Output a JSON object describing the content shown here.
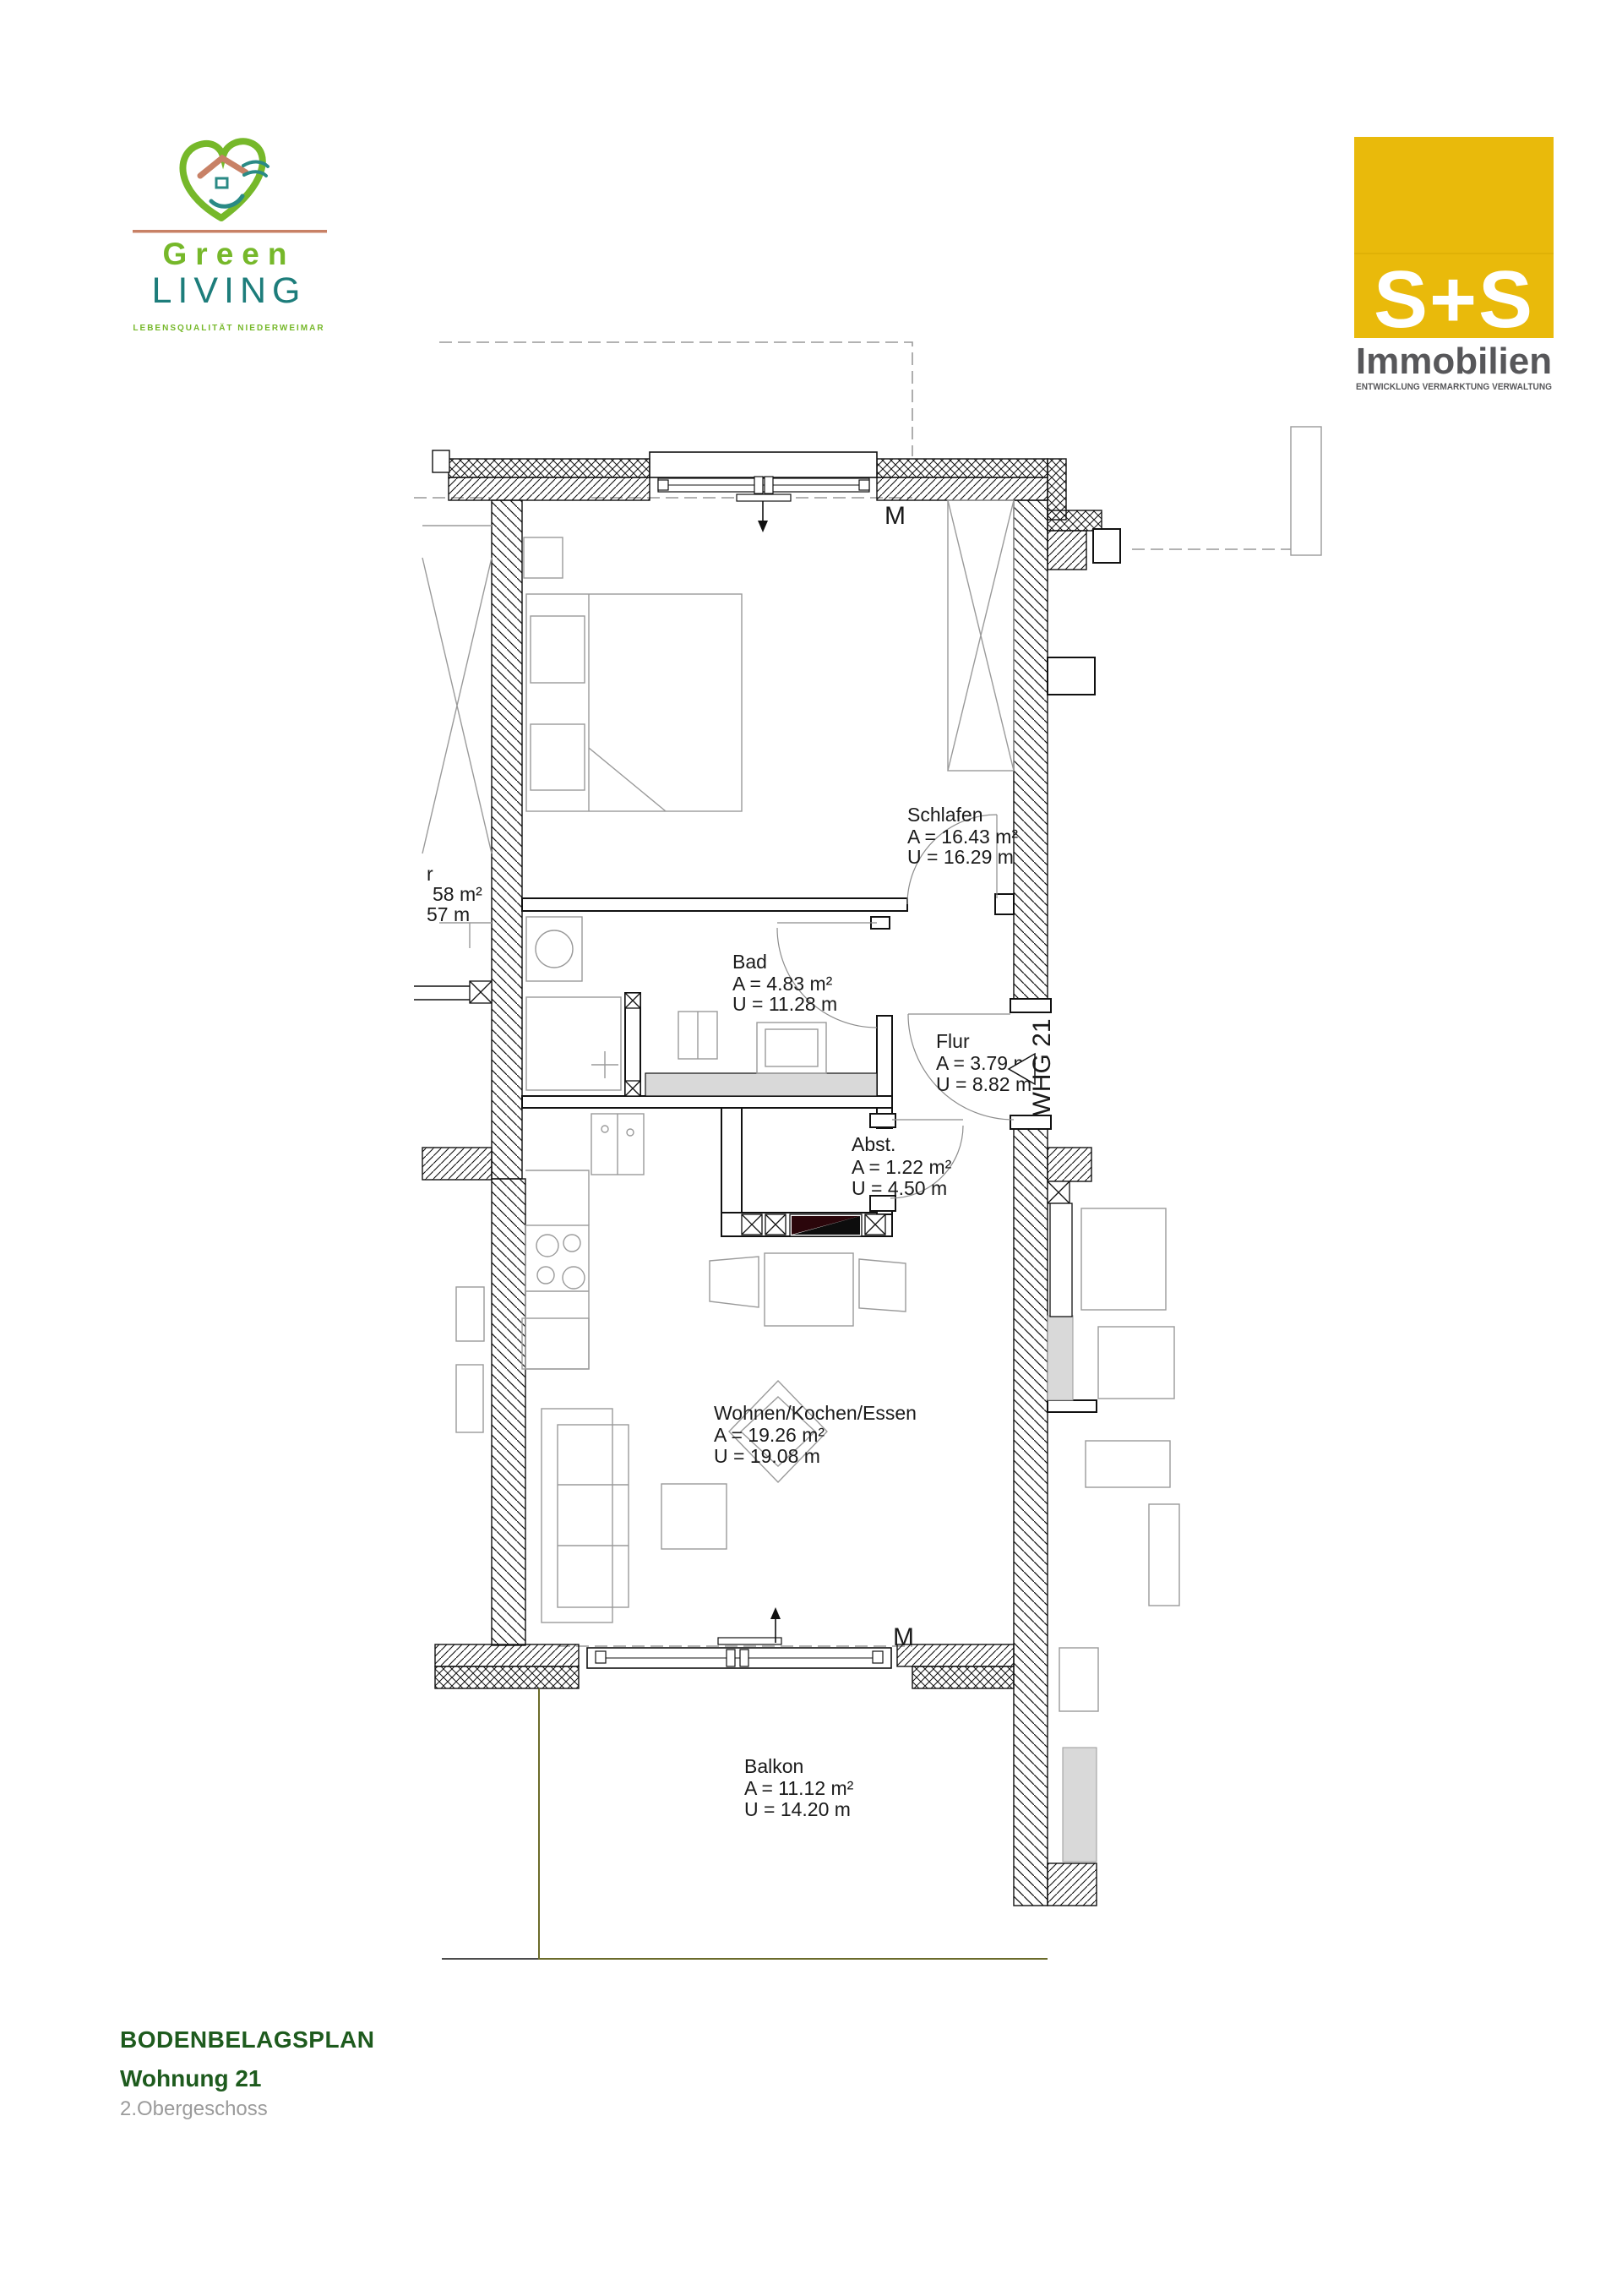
{
  "branding": {
    "green_living": {
      "name_line1": "Green",
      "name_line2": "LIVING",
      "tagline": "LEBENSQUALITÄT NIEDERWEIMAR",
      "green": "#76b82a",
      "teal": "#1d7d7b",
      "salmon": "#c88166"
    },
    "ss_immobilien": {
      "logo_text": "S+S",
      "name": "Immobilien",
      "tagline": "ENTWICKLUNG VERMARKTUNG VERWALTUNG",
      "brand_yellow": "#e9ba0b",
      "text_gray": "#57575a"
    }
  },
  "title_block": {
    "plan_type": "BODENBELAGSPLAN",
    "unit": "Wohnung 21",
    "floor": "2.Obergeschoss"
  },
  "plan": {
    "unit_tag": "WHG 21",
    "marker_top": "M",
    "marker_bottom": "M",
    "rooms": [
      {
        "name": "Schlafen",
        "area": "A = 16.43 m²",
        "perimeter": "U = 16.29 m"
      },
      {
        "name": "Bad",
        "area": "A = 4.83 m²",
        "perimeter": "U = 11.28 m"
      },
      {
        "name": "Flur",
        "area": "A = 3.79 m²",
        "perimeter": "U = 8.82 m"
      },
      {
        "name": "Abst.",
        "area": "A = 1.22 m²",
        "perimeter": "U = 4.50 m"
      },
      {
        "name": "Wohnen/Kochen/Essen",
        "area": "A = 19.26 m²",
        "perimeter": "U = 19.08 m"
      },
      {
        "name": "Balkon",
        "area": "A = 11.12 m²",
        "perimeter": "U = 14.20 m"
      }
    ],
    "neighbor_fragment": {
      "line1": "r",
      "line2": "58 m²",
      "line3": "57 m"
    },
    "colors": {
      "ink": "#111111",
      "furniture_gray": "#9a9a9a",
      "shaded_fill": "#d9d9d9",
      "balcony_olive": "#6b6b2a",
      "shaft_maroon": "#2b060b",
      "dashed_gray": "#999999"
    }
  }
}
